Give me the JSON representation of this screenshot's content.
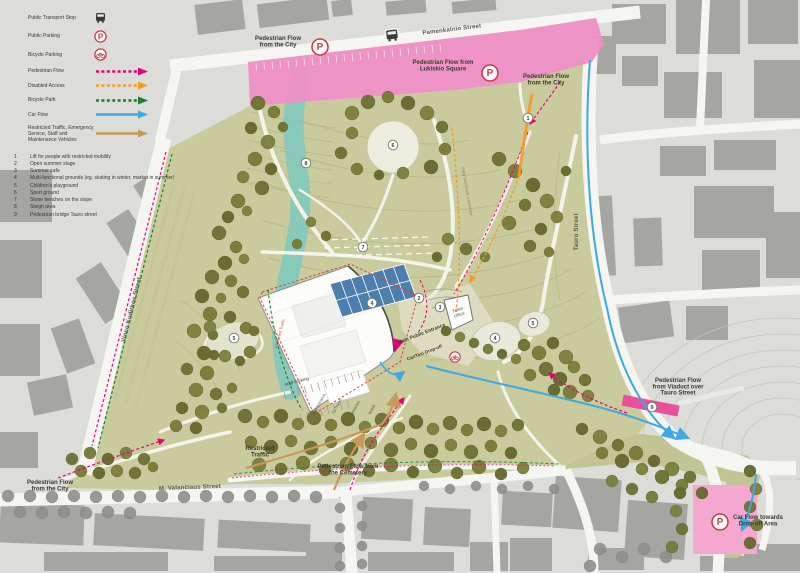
{
  "legend": {
    "point_items": [
      {
        "label": "Public Transport Stop",
        "icon": "bus-icon"
      },
      {
        "label": "Public Parking",
        "icon": "parking-icon"
      },
      {
        "label": "Bicycle Parking",
        "icon": "bicycle-parking-icon"
      }
    ],
    "flow_items": [
      {
        "label": "Pedestrian Flow",
        "color": "#e6007e",
        "dash": true
      },
      {
        "label": "Disabled Access",
        "color": "#f59a23",
        "dash": true
      },
      {
        "label": "Bicycle Path",
        "color": "#1e7a34",
        "dash": true
      },
      {
        "label": "Car Flow",
        "color": "#3fa9e0",
        "dash": false
      },
      {
        "label": "Restricted Traffic, Emergency Service, Staff and Maintenance Vehicles",
        "color": "#c89a5a",
        "dash": false
      }
    ],
    "numbered_items": [
      {
        "num": "1",
        "label": "Lift for people with restricted mobility"
      },
      {
        "num": "2",
        "label": "Open summer stage"
      },
      {
        "num": "3",
        "label": "Summer cafe"
      },
      {
        "num": "4",
        "label": "Multi-functional grounds (eg. skating in winter, market in summer)"
      },
      {
        "num": "5",
        "label": "Children's playground"
      },
      {
        "num": "6",
        "label": "Sport ground"
      },
      {
        "num": "7",
        "label": "Stone benches on the slope"
      },
      {
        "num": "8",
        "label": "Sleigh area"
      },
      {
        "num": "9",
        "label": "Pedestrian bridge Tauro street"
      }
    ]
  },
  "map": {
    "street_labels": [
      {
        "text": "Pamenkalnio Street",
        "x": 452,
        "y": 31,
        "rot": -7
      },
      {
        "text": "Tauro Street",
        "x": 578,
        "y": 232,
        "rot": -90
      },
      {
        "text": "M. Valančiaus Street",
        "x": 190,
        "y": 489,
        "rot": -2
      },
      {
        "text": "Vinco Kudirkos Street",
        "x": 133,
        "y": 310,
        "rot": -76
      }
    ],
    "flow_labels": [
      {
        "text": "Pedestrian Flow\nfrom the City",
        "x": 278,
        "y": 40
      },
      {
        "text": "Pedestrian Flow from\nLukiskio Square",
        "x": 443,
        "y": 64
      },
      {
        "text": "Pedestrian Flow\nfrom the City",
        "x": 546,
        "y": 78
      },
      {
        "text": "Pedestrian Flow\nfrom Viaduct over\nTauro Street",
        "x": 678,
        "y": 382
      },
      {
        "text": "Car Flow towards\nDrop-off Area",
        "x": 758,
        "y": 519
      },
      {
        "text": "Pedestrian Flow\nfrom the City",
        "x": 50,
        "y": 484
      },
      {
        "text": "Restricted\nTraffic",
        "x": 260,
        "y": 450
      },
      {
        "text": "Pedestrian Flow from\nthe Cemetery",
        "x": 348,
        "y": 468
      }
    ],
    "feature_labels": [
      {
        "text": "Main Public Entrance",
        "x": 422,
        "y": 335,
        "rot": -21,
        "size": 5,
        "color": "#3f3f37",
        "bold": true
      },
      {
        "text": "Car/Taxi Drop-off",
        "x": 425,
        "y": 354,
        "rot": -21,
        "size": 4.6,
        "color": "#3f3f37",
        "bold": true
      },
      {
        "text": "Ticket\nOffice",
        "x": 458,
        "y": 311,
        "rot": -20,
        "size": 4.2,
        "color": "#55564a",
        "bold": false
      },
      {
        "text": "Staff Parking",
        "x": 297,
        "y": 383,
        "rot": -16,
        "size": 4.4,
        "color": "#3f3f37",
        "bold": false
      },
      {
        "text": "Staff Entrance",
        "x": 320,
        "y": 405,
        "rot": -62,
        "size": 3.8,
        "color": "#55564a",
        "bold": false
      },
      {
        "text": "TV Trucks",
        "x": 338,
        "y": 407,
        "rot": -62,
        "size": 3.8,
        "color": "#55564a",
        "bold": false
      },
      {
        "text": "Deliveries",
        "x": 356,
        "y": 409,
        "rot": -62,
        "size": 3.8,
        "color": "#55564a",
        "bold": false
      },
      {
        "text": "Waste",
        "x": 373,
        "y": 410,
        "rot": -62,
        "size": 3.8,
        "color": "#55564a",
        "bold": false
      },
      {
        "text": "Easy functional connection",
        "x": 466,
        "y": 192,
        "rot": 80,
        "size": 4.2,
        "color": "#84856c",
        "bold": false
      },
      {
        "text": "Restricted Traffic",
        "x": 281,
        "y": 334,
        "rot": -75,
        "size": 4,
        "color": "#c0504d",
        "bold": false
      }
    ],
    "numbered_markers": [
      {
        "num": "1",
        "x": 528,
        "y": 118
      },
      {
        "num": "2",
        "x": 419,
        "y": 298
      },
      {
        "num": "3",
        "x": 440,
        "y": 307
      },
      {
        "num": "4",
        "x": 372,
        "y": 303
      },
      {
        "num": "4",
        "x": 495,
        "y": 338
      },
      {
        "num": "5",
        "x": 533,
        "y": 323
      },
      {
        "num": "5",
        "x": 234,
        "y": 338
      },
      {
        "num": "6",
        "x": 393,
        "y": 145
      },
      {
        "num": "7",
        "x": 363,
        "y": 247
      },
      {
        "num": "8",
        "x": 306,
        "y": 163
      },
      {
        "num": "9",
        "x": 652,
        "y": 407
      }
    ],
    "parking_markers": [
      {
        "x": 320,
        "y": 47,
        "r": 8
      },
      {
        "x": 490,
        "y": 73,
        "r": 8
      },
      {
        "x": 720,
        "y": 522,
        "r": 8
      }
    ],
    "bus_markers": [
      {
        "x": 392,
        "y": 35
      }
    ],
    "bike_markers": [
      {
        "x": 455,
        "y": 357
      }
    ],
    "colors": {
      "pedestrian": "#e6007e",
      "disabled": "#f59a23",
      "bicycle": "#1e7a34",
      "car": "#3fa9e0",
      "restricted": "#c89a5a",
      "park_green": "#c9cb9c",
      "pink_zone": "#ee8ec5",
      "parking_pink": "#f5a8cf",
      "sleigh_teal": "#79c8c1",
      "grid_blue": "#4d7fae",
      "icon_red": "#cf3a45"
    },
    "trees_park": [
      [
        258,
        103,
        7
      ],
      [
        274,
        112,
        6
      ],
      [
        251,
        128,
        6
      ],
      [
        268,
        142,
        7
      ],
      [
        283,
        127,
        5
      ],
      [
        255,
        159,
        7
      ],
      [
        271,
        169,
        6
      ],
      [
        243,
        177,
        6
      ],
      [
        262,
        188,
        7
      ],
      [
        238,
        201,
        7
      ],
      [
        228,
        217,
        6
      ],
      [
        247,
        211,
        5
      ],
      [
        219,
        233,
        7
      ],
      [
        236,
        247,
        6
      ],
      [
        225,
        263,
        7
      ],
      [
        244,
        259,
        5
      ],
      [
        212,
        277,
        7
      ],
      [
        231,
        281,
        6
      ],
      [
        202,
        296,
        7
      ],
      [
        221,
        298,
        5
      ],
      [
        243,
        292,
        6
      ],
      [
        210,
        314,
        7
      ],
      [
        230,
        317,
        6
      ],
      [
        194,
        331,
        7
      ],
      [
        213,
        335,
        5
      ],
      [
        246,
        328,
        6
      ],
      [
        204,
        353,
        7
      ],
      [
        225,
        356,
        6
      ],
      [
        187,
        369,
        6
      ],
      [
        207,
        373,
        7
      ],
      [
        240,
        361,
        5
      ],
      [
        196,
        390,
        7
      ],
      [
        216,
        394,
        6
      ],
      [
        232,
        388,
        5
      ],
      [
        182,
        408,
        6
      ],
      [
        202,
        412,
        7
      ],
      [
        222,
        408,
        5
      ],
      [
        176,
        426,
        6
      ],
      [
        196,
        428,
        6
      ],
      [
        352,
        113,
        7
      ],
      [
        368,
        102,
        7
      ],
      [
        388,
        97,
        6
      ],
      [
        408,
        103,
        7
      ],
      [
        427,
        113,
        7
      ],
      [
        442,
        127,
        6
      ],
      [
        445,
        149,
        6
      ],
      [
        431,
        167,
        7
      ],
      [
        352,
        133,
        6
      ],
      [
        341,
        153,
        6
      ],
      [
        357,
        169,
        6
      ],
      [
        379,
        175,
        5
      ],
      [
        403,
        173,
        6
      ],
      [
        499,
        159,
        7
      ],
      [
        515,
        171,
        7
      ],
      [
        533,
        185,
        7
      ],
      [
        547,
        201,
        7
      ],
      [
        525,
        205,
        6
      ],
      [
        509,
        223,
        7
      ],
      [
        541,
        229,
        6
      ],
      [
        557,
        217,
        6
      ],
      [
        530,
        246,
        6
      ],
      [
        549,
        252,
        5
      ],
      [
        566,
        171,
        5
      ],
      [
        448,
        239,
        6
      ],
      [
        466,
        249,
        6
      ],
      [
        485,
        257,
        5
      ],
      [
        437,
        257,
        5
      ],
      [
        311,
        222,
        5
      ],
      [
        326,
        236,
        5
      ],
      [
        297,
        244,
        5
      ],
      [
        446,
        331,
        5
      ],
      [
        460,
        337,
        5
      ],
      [
        474,
        343,
        5
      ],
      [
        488,
        349,
        5
      ],
      [
        502,
        354,
        5
      ],
      [
        516,
        359,
        5
      ],
      [
        524,
        345,
        6
      ],
      [
        539,
        353,
        7
      ],
      [
        553,
        343,
        6
      ],
      [
        566,
        357,
        7
      ],
      [
        546,
        369,
        7
      ],
      [
        530,
        375,
        6
      ],
      [
        560,
        379,
        7
      ],
      [
        574,
        367,
        6
      ],
      [
        585,
        380,
        6
      ],
      [
        570,
        392,
        7
      ],
      [
        554,
        390,
        6
      ],
      [
        588,
        396,
        6
      ],
      [
        245,
        416,
        7
      ],
      [
        263,
        422,
        6
      ],
      [
        281,
        416,
        7
      ],
      [
        298,
        424,
        6
      ],
      [
        314,
        418,
        7
      ],
      [
        331,
        425,
        6
      ],
      [
        348,
        419,
        7
      ],
      [
        365,
        427,
        6
      ],
      [
        382,
        420,
        7
      ],
      [
        399,
        428,
        6
      ],
      [
        416,
        422,
        7
      ],
      [
        433,
        429,
        6
      ],
      [
        450,
        423,
        7
      ],
      [
        467,
        430,
        6
      ],
      [
        484,
        424,
        7
      ],
      [
        501,
        431,
        6
      ],
      [
        518,
        425,
        6
      ],
      [
        251,
        442,
        6
      ],
      [
        271,
        447,
        7
      ],
      [
        291,
        441,
        6
      ],
      [
        311,
        448,
        7
      ],
      [
        331,
        442,
        6
      ],
      [
        351,
        449,
        7
      ],
      [
        371,
        443,
        6
      ],
      [
        391,
        450,
        7
      ],
      [
        411,
        444,
        6
      ],
      [
        431,
        451,
        7
      ],
      [
        451,
        445,
        6
      ],
      [
        471,
        452,
        7
      ],
      [
        491,
        446,
        6
      ],
      [
        511,
        453,
        6
      ],
      [
        259,
        465,
        7
      ],
      [
        281,
        469,
        6
      ],
      [
        303,
        463,
        7
      ],
      [
        325,
        470,
        6
      ],
      [
        347,
        464,
        7
      ],
      [
        369,
        471,
        6
      ],
      [
        391,
        465,
        7
      ],
      [
        413,
        472,
        6
      ],
      [
        435,
        466,
        7
      ],
      [
        457,
        473,
        6
      ],
      [
        479,
        467,
        7
      ],
      [
        501,
        474,
        6
      ],
      [
        523,
        468,
        6
      ],
      [
        72,
        459,
        6
      ],
      [
        90,
        453,
        6
      ],
      [
        108,
        459,
        6
      ],
      [
        126,
        453,
        6
      ],
      [
        144,
        459,
        6
      ],
      [
        81,
        471,
        6
      ],
      [
        99,
        473,
        6
      ],
      [
        117,
        471,
        6
      ],
      [
        135,
        473,
        6
      ],
      [
        153,
        467,
        5
      ],
      [
        582,
        429,
        6
      ],
      [
        600,
        437,
        7
      ],
      [
        618,
        445,
        6
      ],
      [
        636,
        453,
        7
      ],
      [
        654,
        461,
        6
      ],
      [
        672,
        469,
        7
      ],
      [
        690,
        477,
        6
      ],
      [
        602,
        453,
        6
      ],
      [
        622,
        461,
        7
      ],
      [
        642,
        469,
        6
      ],
      [
        662,
        477,
        7
      ],
      [
        682,
        485,
        6
      ],
      [
        702,
        493,
        6
      ],
      [
        612,
        481,
        6
      ],
      [
        632,
        489,
        6
      ],
      [
        652,
        497,
        6
      ],
      [
        680,
        493,
        6
      ],
      [
        676,
        511,
        6
      ],
      [
        682,
        529,
        6
      ],
      [
        672,
        547,
        6
      ],
      [
        750,
        471,
        6
      ],
      [
        756,
        489,
        6
      ],
      [
        750,
        507,
        6
      ],
      [
        757,
        525,
        6
      ],
      [
        750,
        543,
        6
      ],
      [
        210,
        327,
        6
      ],
      [
        254,
        331,
        5
      ],
      [
        250,
        352,
        6
      ],
      [
        214,
        355,
        5
      ]
    ],
    "trees_street": [
      [
        8,
        496,
        6
      ],
      [
        30,
        496,
        6
      ],
      [
        52,
        497,
        6
      ],
      [
        74,
        496,
        6
      ],
      [
        96,
        497,
        6
      ],
      [
        118,
        496,
        6
      ],
      [
        140,
        497,
        6
      ],
      [
        162,
        496,
        6
      ],
      [
        184,
        497,
        6
      ],
      [
        206,
        496,
        6
      ],
      [
        228,
        497,
        6
      ],
      [
        250,
        496,
        6
      ],
      [
        272,
        497,
        6
      ],
      [
        294,
        496,
        6
      ],
      [
        316,
        497,
        6
      ],
      [
        20,
        512,
        6
      ],
      [
        42,
        513,
        6
      ],
      [
        64,
        512,
        6
      ],
      [
        86,
        513,
        6
      ],
      [
        108,
        512,
        6
      ],
      [
        130,
        513,
        6
      ],
      [
        340,
        508,
        5
      ],
      [
        362,
        506,
        5
      ],
      [
        340,
        528,
        5
      ],
      [
        362,
        526,
        5
      ],
      [
        340,
        548,
        5
      ],
      [
        362,
        546,
        5
      ],
      [
        340,
        566,
        5
      ],
      [
        362,
        564,
        5
      ],
      [
        424,
        486,
        5
      ],
      [
        450,
        489,
        5
      ],
      [
        476,
        486,
        5
      ],
      [
        502,
        489,
        5
      ],
      [
        528,
        486,
        5
      ],
      [
        554,
        489,
        5
      ],
      [
        600,
        549,
        6
      ],
      [
        622,
        557,
        6
      ],
      [
        644,
        549,
        6
      ],
      [
        590,
        566,
        6
      ],
      [
        666,
        557,
        6
      ]
    ]
  }
}
